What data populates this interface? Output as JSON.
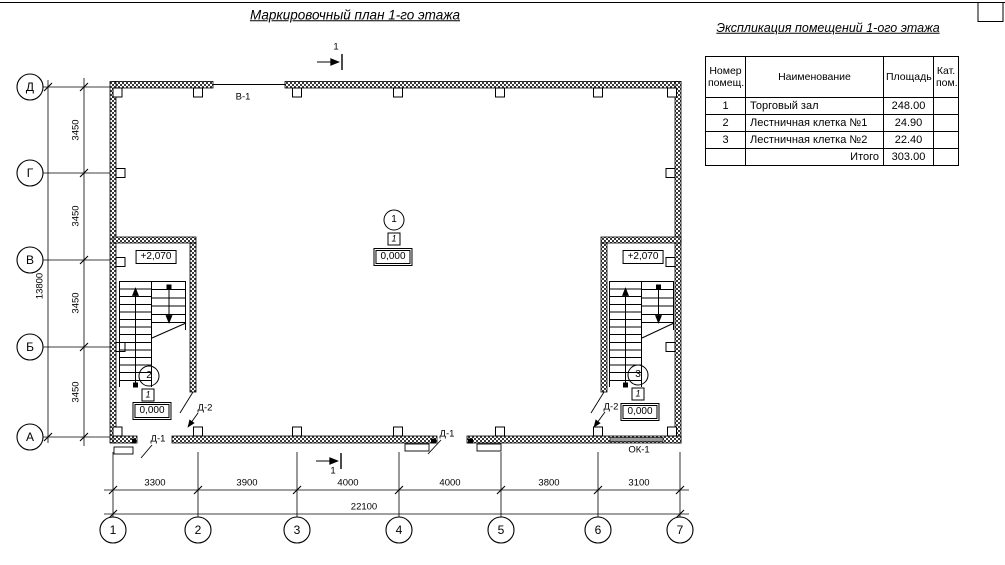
{
  "drawing": {
    "title": "Маркировочный план 1-го этажа"
  },
  "explication": {
    "title": "Экспликация помещений 1-ого этажа",
    "headers": [
      "Номер помещ.",
      "Наименование",
      "Площадь",
      "Кат. пом."
    ],
    "rows": [
      {
        "num": "1",
        "name": "Торговый зал",
        "area": "248.00",
        "cat": ""
      },
      {
        "num": "2",
        "name": "Лестничная клетка №1",
        "area": "24.90",
        "cat": ""
      },
      {
        "num": "3",
        "name": "Лестничная клетка №2",
        "area": "22.40",
        "cat": ""
      }
    ],
    "total": {
      "label": "Итого",
      "value": "303.00"
    }
  },
  "plan": {
    "row_axes": [
      "Д",
      "Г",
      "В",
      "Б",
      "А"
    ],
    "col_axes": [
      "1",
      "2",
      "3",
      "4",
      "5",
      "6",
      "7"
    ],
    "dims": {
      "left_segments": [
        "3450",
        "3450",
        "3450",
        "3450"
      ],
      "left_total": "13800",
      "bottom_segments": [
        "3300",
        "3900",
        "4000",
        "4000",
        "3800",
        "3100"
      ],
      "bottom_total": "22100"
    },
    "marks": {
      "section": "1",
      "window_top": "В-1",
      "window_bottom": "ОК-1",
      "door_exterior": "Д-1",
      "door_interior": "Д-2",
      "level_upper": "+2,070",
      "level_ground": "0,000",
      "category": "1"
    },
    "room_tags": [
      "1",
      "2",
      "3"
    ]
  }
}
